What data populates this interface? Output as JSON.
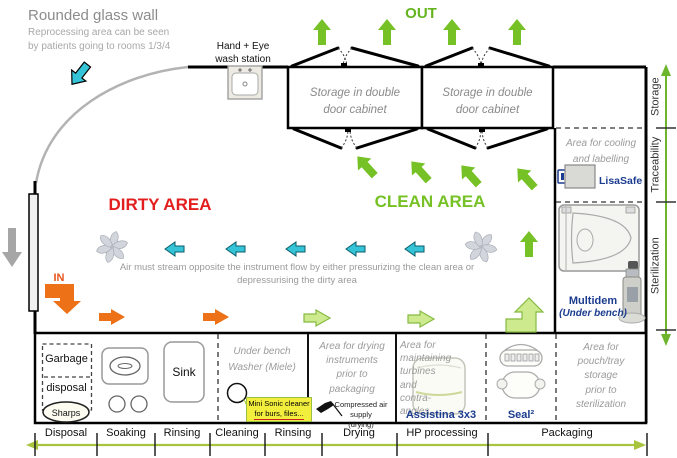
{
  "annotations": {
    "glass_wall_title": "Rounded glass wall",
    "glass_wall_subtitle": "Reprocessing area can be seen\nby patients going to rooms 1/3/4",
    "hand_eye_station": "Hand + Eye\nwash station",
    "air_flow_note": "Air must stream opposite the instrument flow by either pressurizing the clean area or depressurising the dirty area"
  },
  "zones": {
    "dirty": "DIRTY AREA",
    "clean": "CLEAN AREA",
    "in_label": "IN",
    "out_label": "OUT"
  },
  "storage": {
    "cabinet1": "Storage in double\ndoor cabinet",
    "cabinet2": "Storage in double\ndoor cabinet"
  },
  "right_column": {
    "cooling": "Area for cooling\nand labelling",
    "lisasafe": "LisaSafe",
    "multidem": "Multidem",
    "multidem_note": "(Under bench)",
    "pouch": "Area for\npouch/tray\nstorage\nprior to\nsterilization"
  },
  "side_axis": [
    "Storage",
    "Traceability",
    "Sterilization"
  ],
  "bench": {
    "garbage_top": "Garbage",
    "garbage_bottom": "disposal",
    "sharps": "Sharps",
    "sink": "Sink",
    "washer": "Under bench\nWasher (Miele)",
    "sonic_line1": "Mini Sonic cleaner",
    "sonic_line2": "for burs, files...",
    "drying": "Area for drying\ninstruments\nprior to\npackaging",
    "compressed_air": "Compressed air supply\n(drying)",
    "maintaining": "Area for maintaining\nturbines\nand\ncontra-\nangles",
    "assistina": "Assistina 3x3",
    "seal": "Seal²"
  },
  "process_axis": [
    "Disposal",
    "Soaking",
    "Rinsing",
    "Cleaning",
    "Rinsing",
    "Drying",
    "HP processing",
    "Packaging"
  ],
  "colors": {
    "green_arrow": "#76c226",
    "light_green_arrow": "#cdea8e",
    "cyan_arrow": "#35c4d7",
    "orange_arrow": "#ed7117",
    "dirty_red": "#e31e1e",
    "clean_green": "#76c226",
    "product_navy": "#1b3c8f",
    "bottom_axis_green": "#a9c43e",
    "side_axis_green": "#6cb52c",
    "muted_gray": "#9b9b9b"
  }
}
